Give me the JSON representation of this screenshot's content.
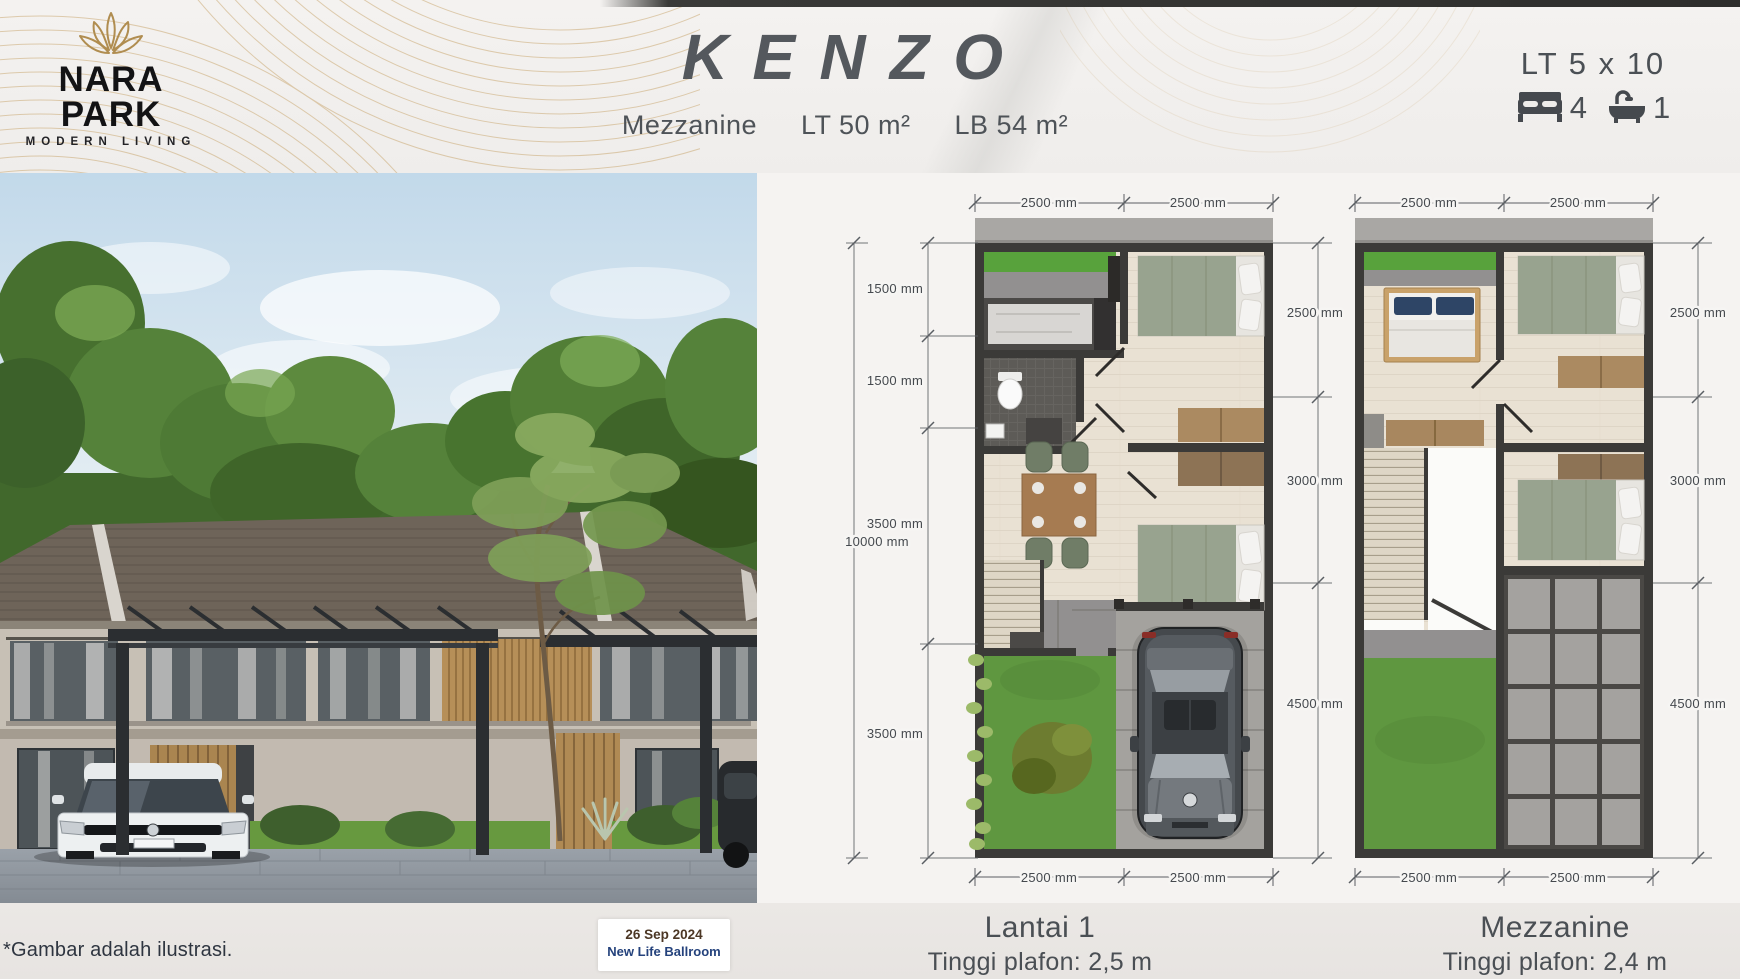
{
  "header": {
    "logo": {
      "name": "NARA PARK",
      "tagline": "MODERN LIVING"
    },
    "title": "KENZO",
    "subtitle": {
      "type": "Mezzanine",
      "lt": "LT 50 m²",
      "lb": "LB 54 m²"
    },
    "specs": {
      "lot": "LT 5 x 10",
      "bedrooms": "4",
      "bathrooms": "1"
    }
  },
  "plans": {
    "lantai1": {
      "name": "Lantai 1",
      "ceiling": "Tinggi plafon: 2,5 m",
      "dims_top": [
        "2500 mm",
        "2500 mm"
      ],
      "dims_bottom": [
        "2500 mm",
        "2500 mm"
      ],
      "dims_left": [
        "1500 mm",
        "1500 mm",
        "3500 mm",
        "3500 mm"
      ],
      "dim_total_left": "10000 mm",
      "dims_right": [
        "2500 mm",
        "3000 mm",
        "4500 mm"
      ]
    },
    "mezzanine": {
      "name": "Mezzanine",
      "ceiling": "Tinggi plafon: 2,4 m",
      "dims_top": [
        "2500 mm",
        "2500 mm"
      ],
      "dims_bottom": [
        "2500 mm",
        "2500 mm"
      ],
      "dims_right": [
        "2500 mm",
        "3000 mm",
        "4500 mm"
      ]
    }
  },
  "footer": {
    "disclaimer": "*Gambar adalah ilustrasi.",
    "event": {
      "date": "26 Sep 2024",
      "venue": "New Life Ballroom"
    }
  },
  "colors": {
    "gold": "#b5905a",
    "ink": "#4c5156",
    "wall": "#3b3a38",
    "floor": "#e9e1d3",
    "grass": "#5f9740",
    "sage": "#98a38f",
    "wood": "#ab8a61",
    "badge_navy": "#24427c",
    "badge_brown": "#4c3725"
  }
}
